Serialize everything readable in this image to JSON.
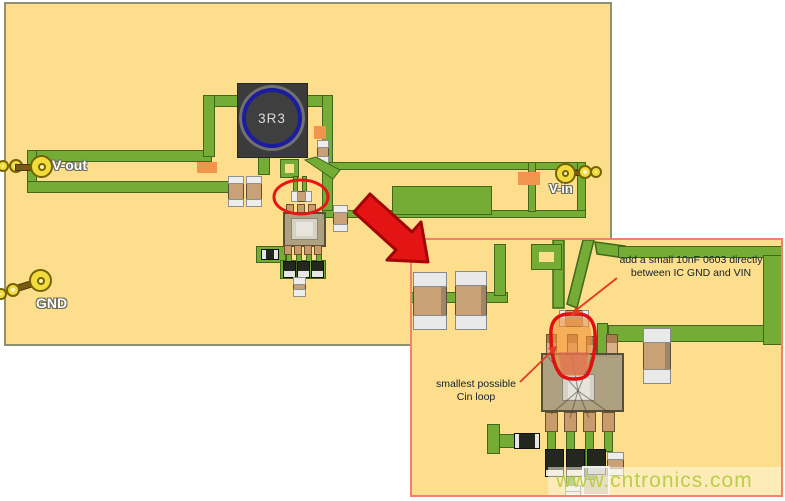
{
  "board": {
    "labels": {
      "vout": "V-out",
      "gnd": "GND",
      "vin": "V-in"
    },
    "inductor_label": "3R3"
  },
  "inset": {
    "annotations": {
      "cap_note": [
        "add a small 10nF 0603 directly",
        "between IC GND and VIN"
      ],
      "loop_note": [
        "smallest possible",
        "Cin loop"
      ]
    }
  },
  "watermark": "www.cntronics.com",
  "colors": {
    "board_substrate": "#FCDE8C",
    "copper_trace_green": "#74AC36",
    "trace_outline": "#40671B",
    "highlight_red": "#E91414",
    "inset_border_salmon": "#F2826E",
    "solder_paste_orange": "#F0944E",
    "component_tan": "#C9A177",
    "inductor_body": "#3B3B3B",
    "inductor_ring_blue": "#1C1C9E",
    "connector_yellow": "#F2DC3C",
    "annotation_text": "#14202E",
    "watermark_green": "#B4CE47"
  }
}
